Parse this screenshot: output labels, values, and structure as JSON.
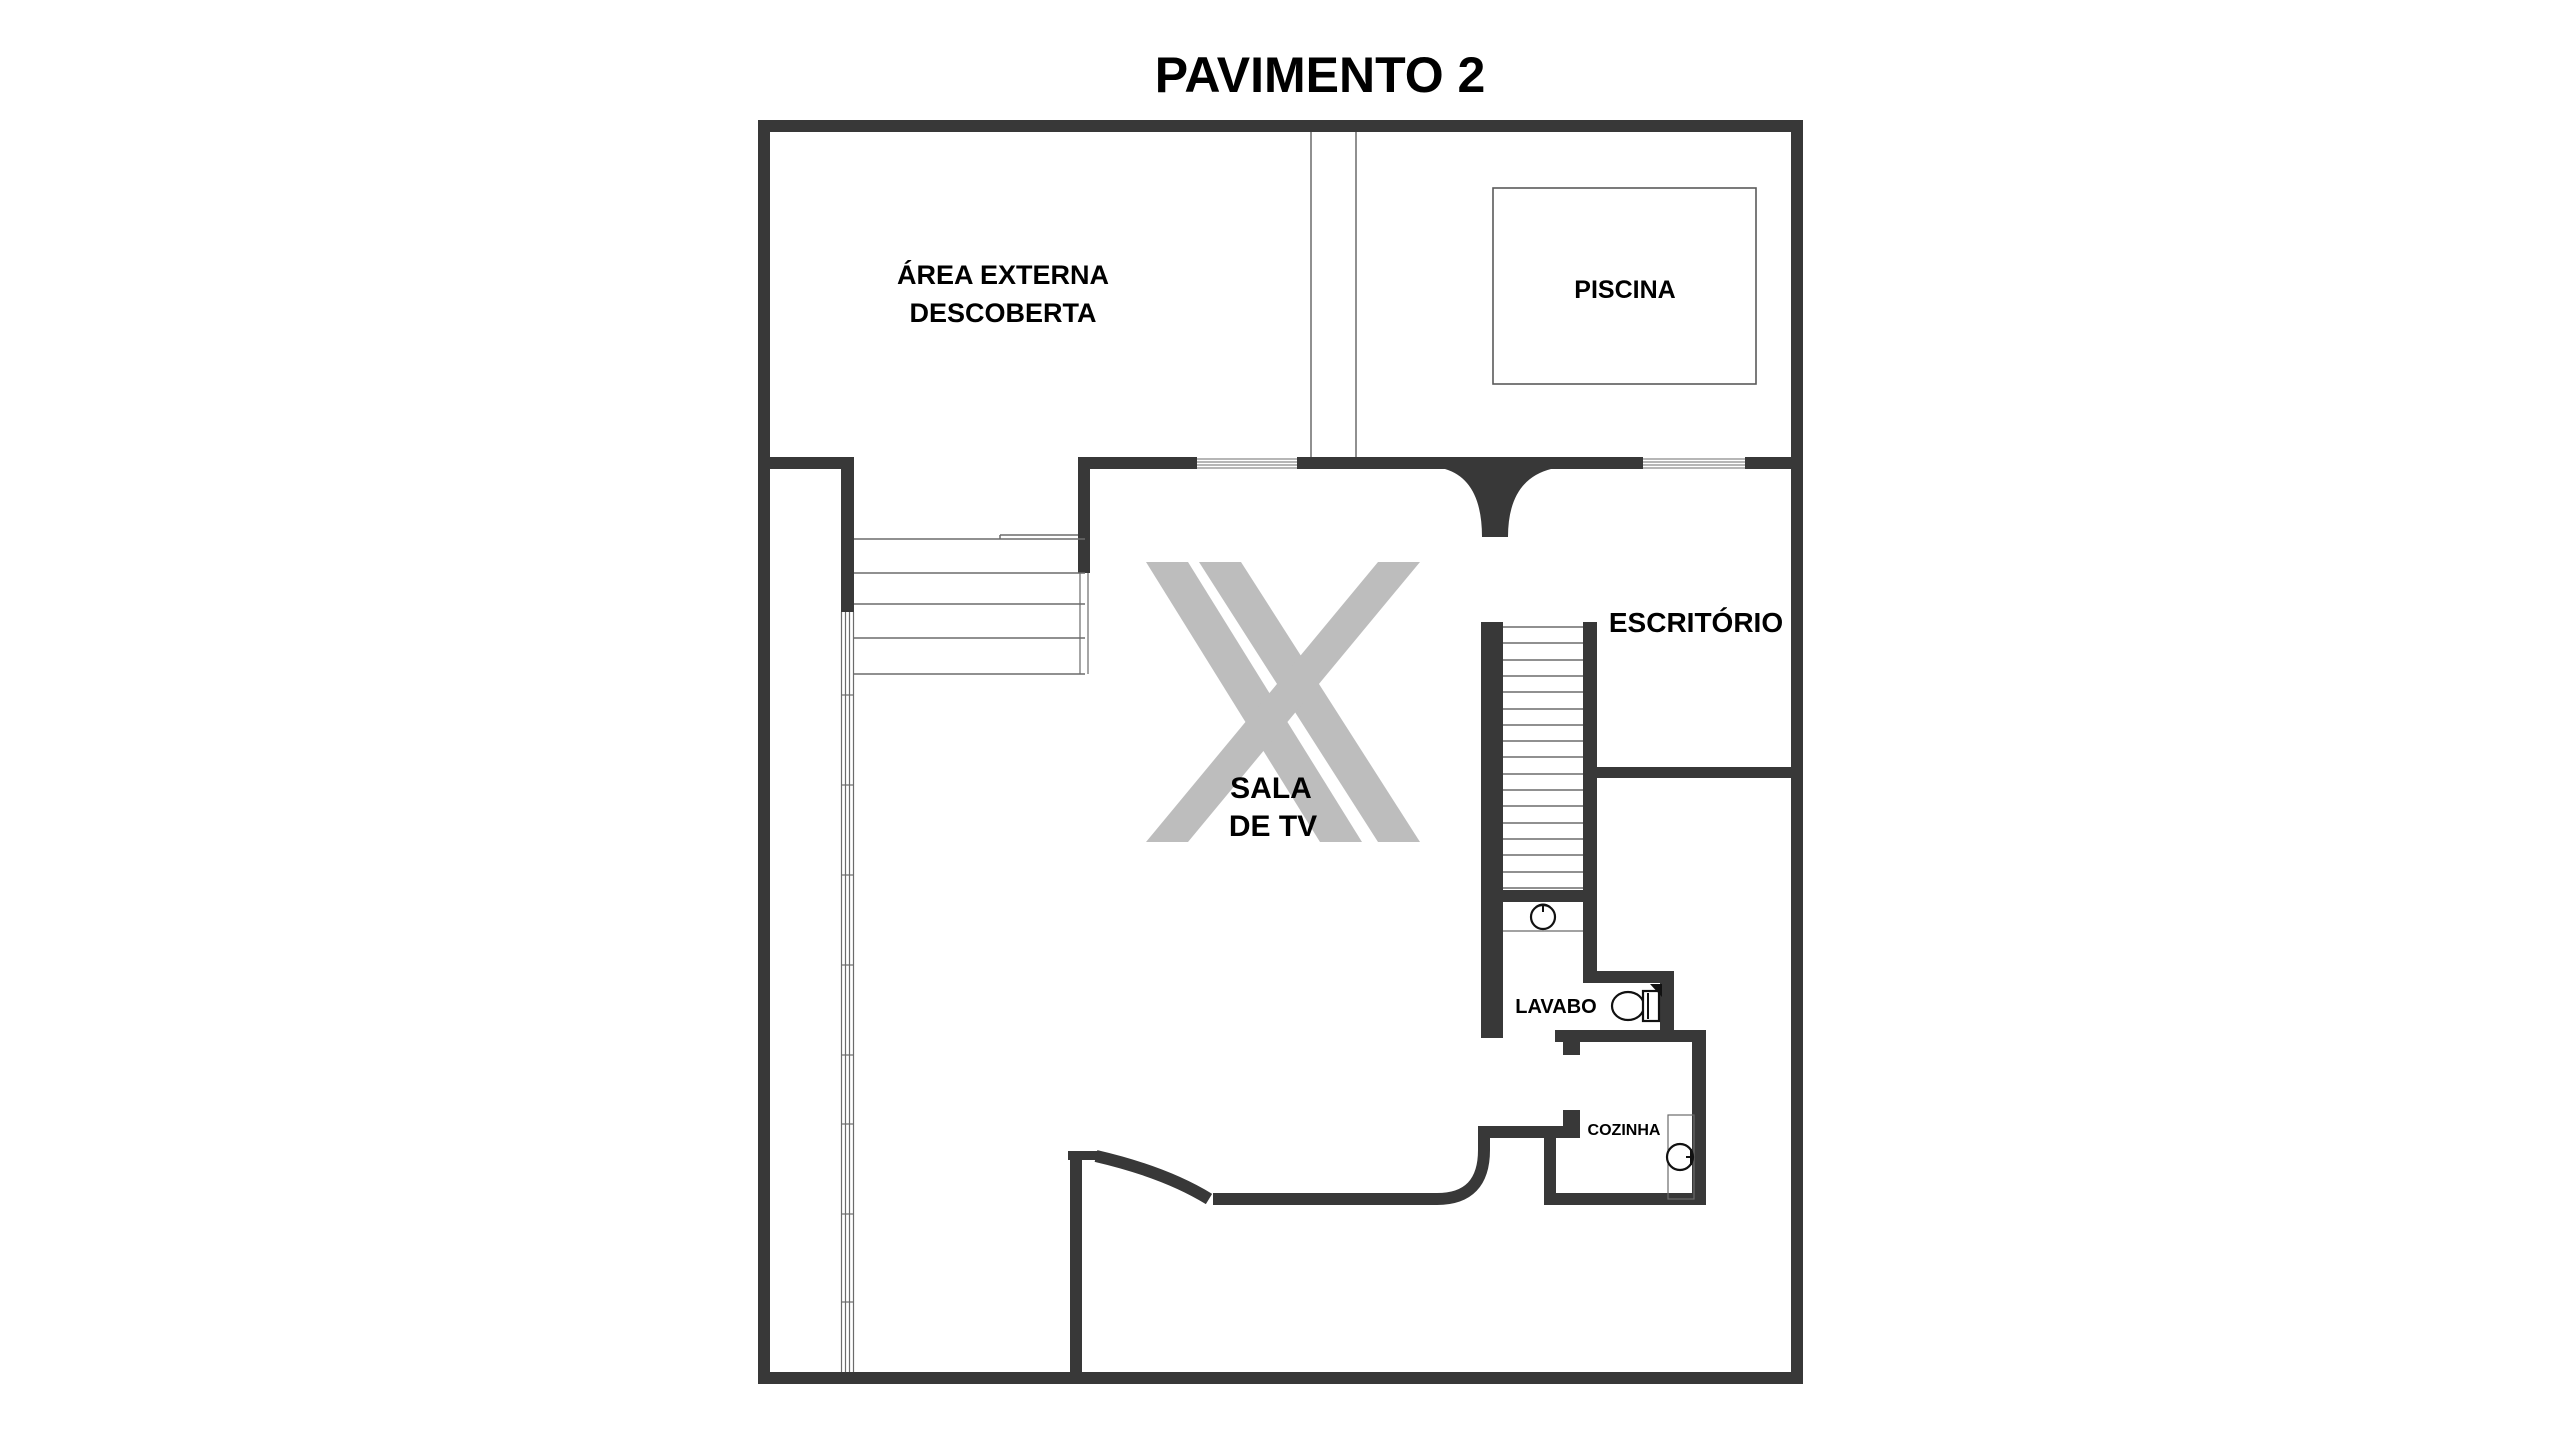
{
  "title": "PAVIMENTO 2",
  "rooms": {
    "area_externa": {
      "name_line1": "ÁREA EXTERNA",
      "name_line2": "DESCOBERTA"
    },
    "piscina": {
      "name": "PISCINA"
    },
    "sala_de_tv": {
      "name_line1": "SALA",
      "name_line2": "DE TV"
    },
    "escritorio": {
      "name": "ESCRITÓRIO"
    },
    "lavabo": {
      "name": "LAVABO"
    },
    "cozinha": {
      "name": "COZINHA"
    }
  },
  "icons": {
    "watermark": "double-x-logo",
    "stairs_main": "staircase-treads",
    "stairs_entry": "entry-steps",
    "toilet": "toilet-plan-symbol",
    "lavabo_sink": "round-washbasin-symbol",
    "kitchen_sink": "round-kitchen-sink-symbol",
    "pool": "pool-outline",
    "windows": "glazing-hatch"
  },
  "colors": {
    "background": "#ffffff",
    "wall": "#383838",
    "thin": "#6b6b6b",
    "fixture": "#111111",
    "watermark": "#bdbdbd",
    "text": "#000000"
  }
}
